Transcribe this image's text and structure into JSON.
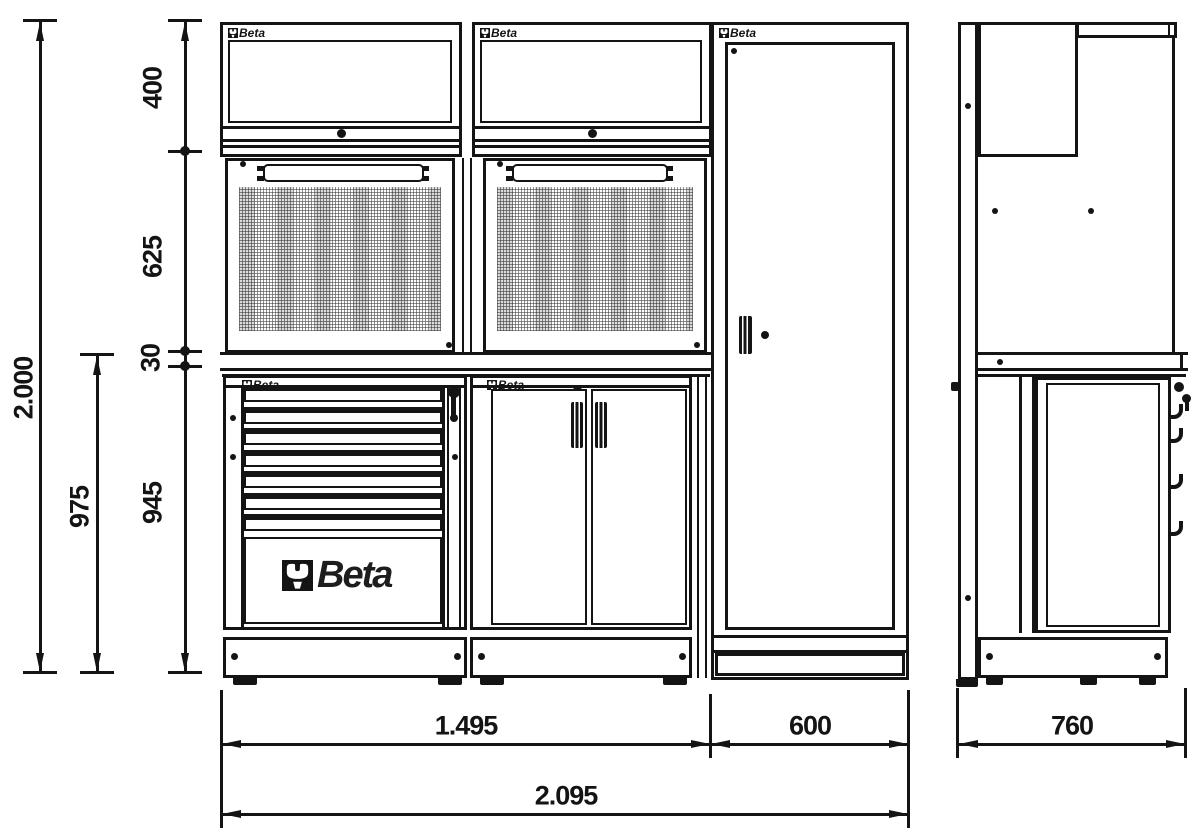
{
  "brand_logo": {
    "text": "Beta"
  },
  "colors": {
    "line": "#141414",
    "background": "#ffffff",
    "perforation_grid": "#707070"
  },
  "dimensions": {
    "vertical": {
      "overall_height": "2.000",
      "worktop_level_height": "975",
      "wall_unit_height": "400",
      "back_panel_height": "625",
      "worktop_thickness": "30",
      "base_unit_height": "945"
    },
    "horizontal": {
      "cabinets_section_width": "1.495",
      "locker_width": "600",
      "overall_width": "2.095",
      "depth": "760"
    }
  }
}
